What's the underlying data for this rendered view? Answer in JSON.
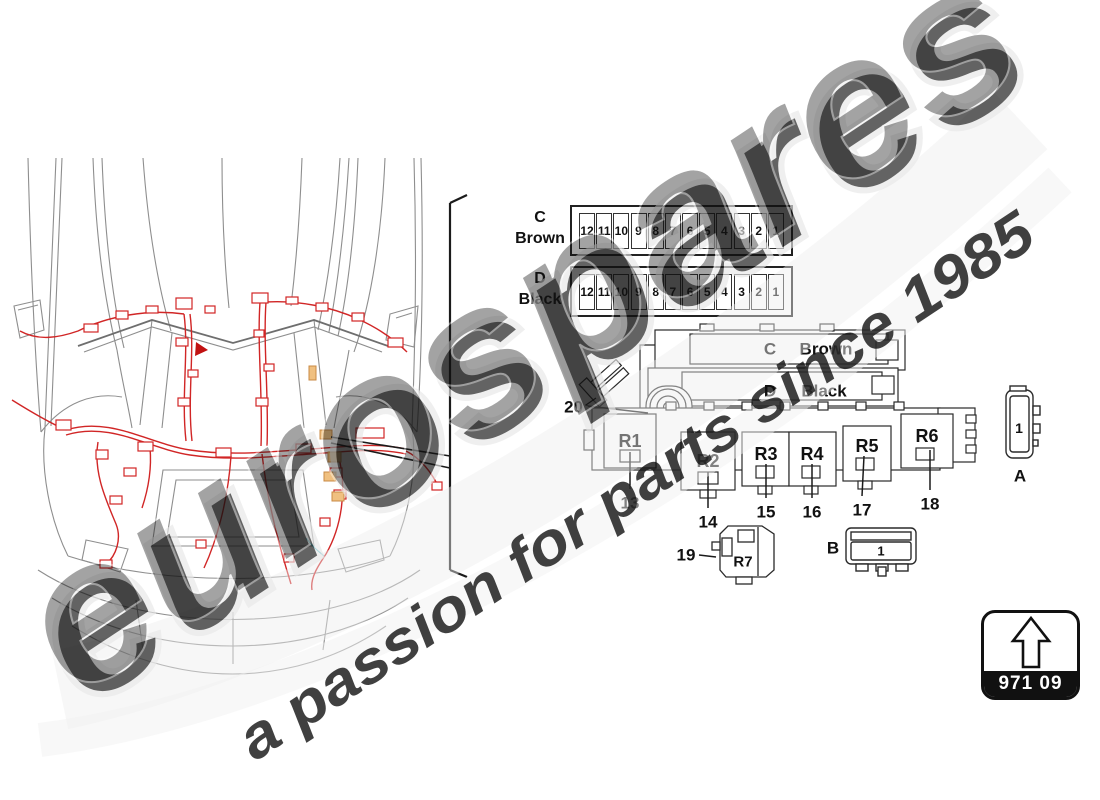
{
  "watermark": {
    "brand": "eurospares",
    "tagline": "a passion for parts since 1985",
    "brand_color": "#d8d8d8",
    "tagline_color": "#ece27f"
  },
  "fuse_rows": [
    {
      "letter": "C",
      "color_name": "Brown",
      "fuses": [
        "12",
        "11",
        "10",
        "9",
        "8",
        "7",
        "6",
        "5",
        "4",
        "3",
        "2",
        "1"
      ]
    },
    {
      "letter": "D",
      "color_name": "Black",
      "fuses": [
        "12",
        "11",
        "10",
        "9",
        "8",
        "7",
        "6",
        "5",
        "4",
        "3",
        "2",
        "1"
      ]
    }
  ],
  "fusebox": {
    "strip_c_letter": "C",
    "strip_c_label": "Brown",
    "strip_d_letter": "D",
    "strip_d_label": "Black",
    "relays": [
      "R1",
      "R2",
      "R3",
      "R4",
      "R5",
      "R6"
    ],
    "callouts": [
      "13",
      "14",
      "15",
      "16",
      "17",
      "18"
    ],
    "callout_20": "20"
  },
  "relay_19": {
    "callout": "19",
    "label": "R7"
  },
  "connector_a": {
    "pin": "1",
    "label": "A"
  },
  "connector_b": {
    "label": "B",
    "pin": "1"
  },
  "part_code": {
    "number": "971 09"
  },
  "colors": {
    "harness_red": "#d12626",
    "car_gray": "#8e8e8e",
    "line_black": "#2a2a2a"
  }
}
